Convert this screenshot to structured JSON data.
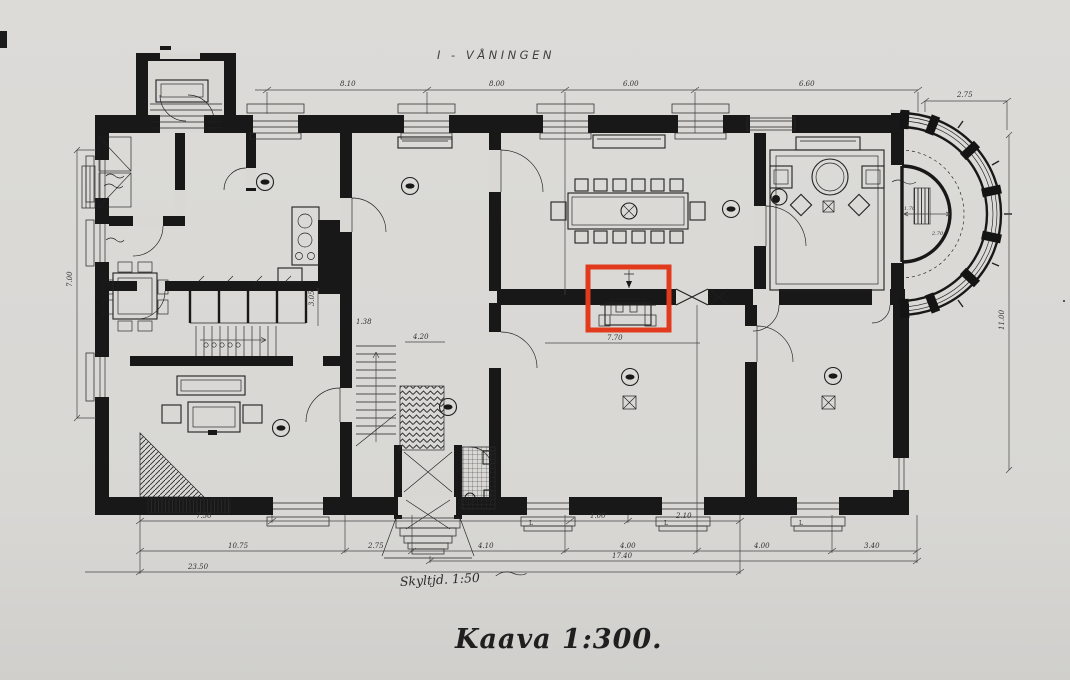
{
  "plan": {
    "title": "I - VÅNINGEN",
    "caption": "Kaava 1:300.",
    "note": "Skyltjd. 1:50"
  },
  "dims": {
    "top": [
      "8.10",
      "8.00",
      "6.00",
      "6.60"
    ],
    "top_right": "2.75",
    "row1": [
      "7.50",
      "1.00",
      "2.10"
    ],
    "row2": [
      "10.75",
      "2.75",
      "4.10",
      "4.00",
      "4.00",
      "3.40"
    ],
    "total_right": "17.40",
    "total_left": "23.50",
    "left": "7.00",
    "right": "11.00",
    "interior": [
      "4.20",
      "1.38",
      "7.70",
      "3.05"
    ],
    "bay": [
      "1.70",
      "2.70"
    ],
    "window_mark": "L"
  },
  "annotation": {
    "color": "#e23a1d"
  }
}
